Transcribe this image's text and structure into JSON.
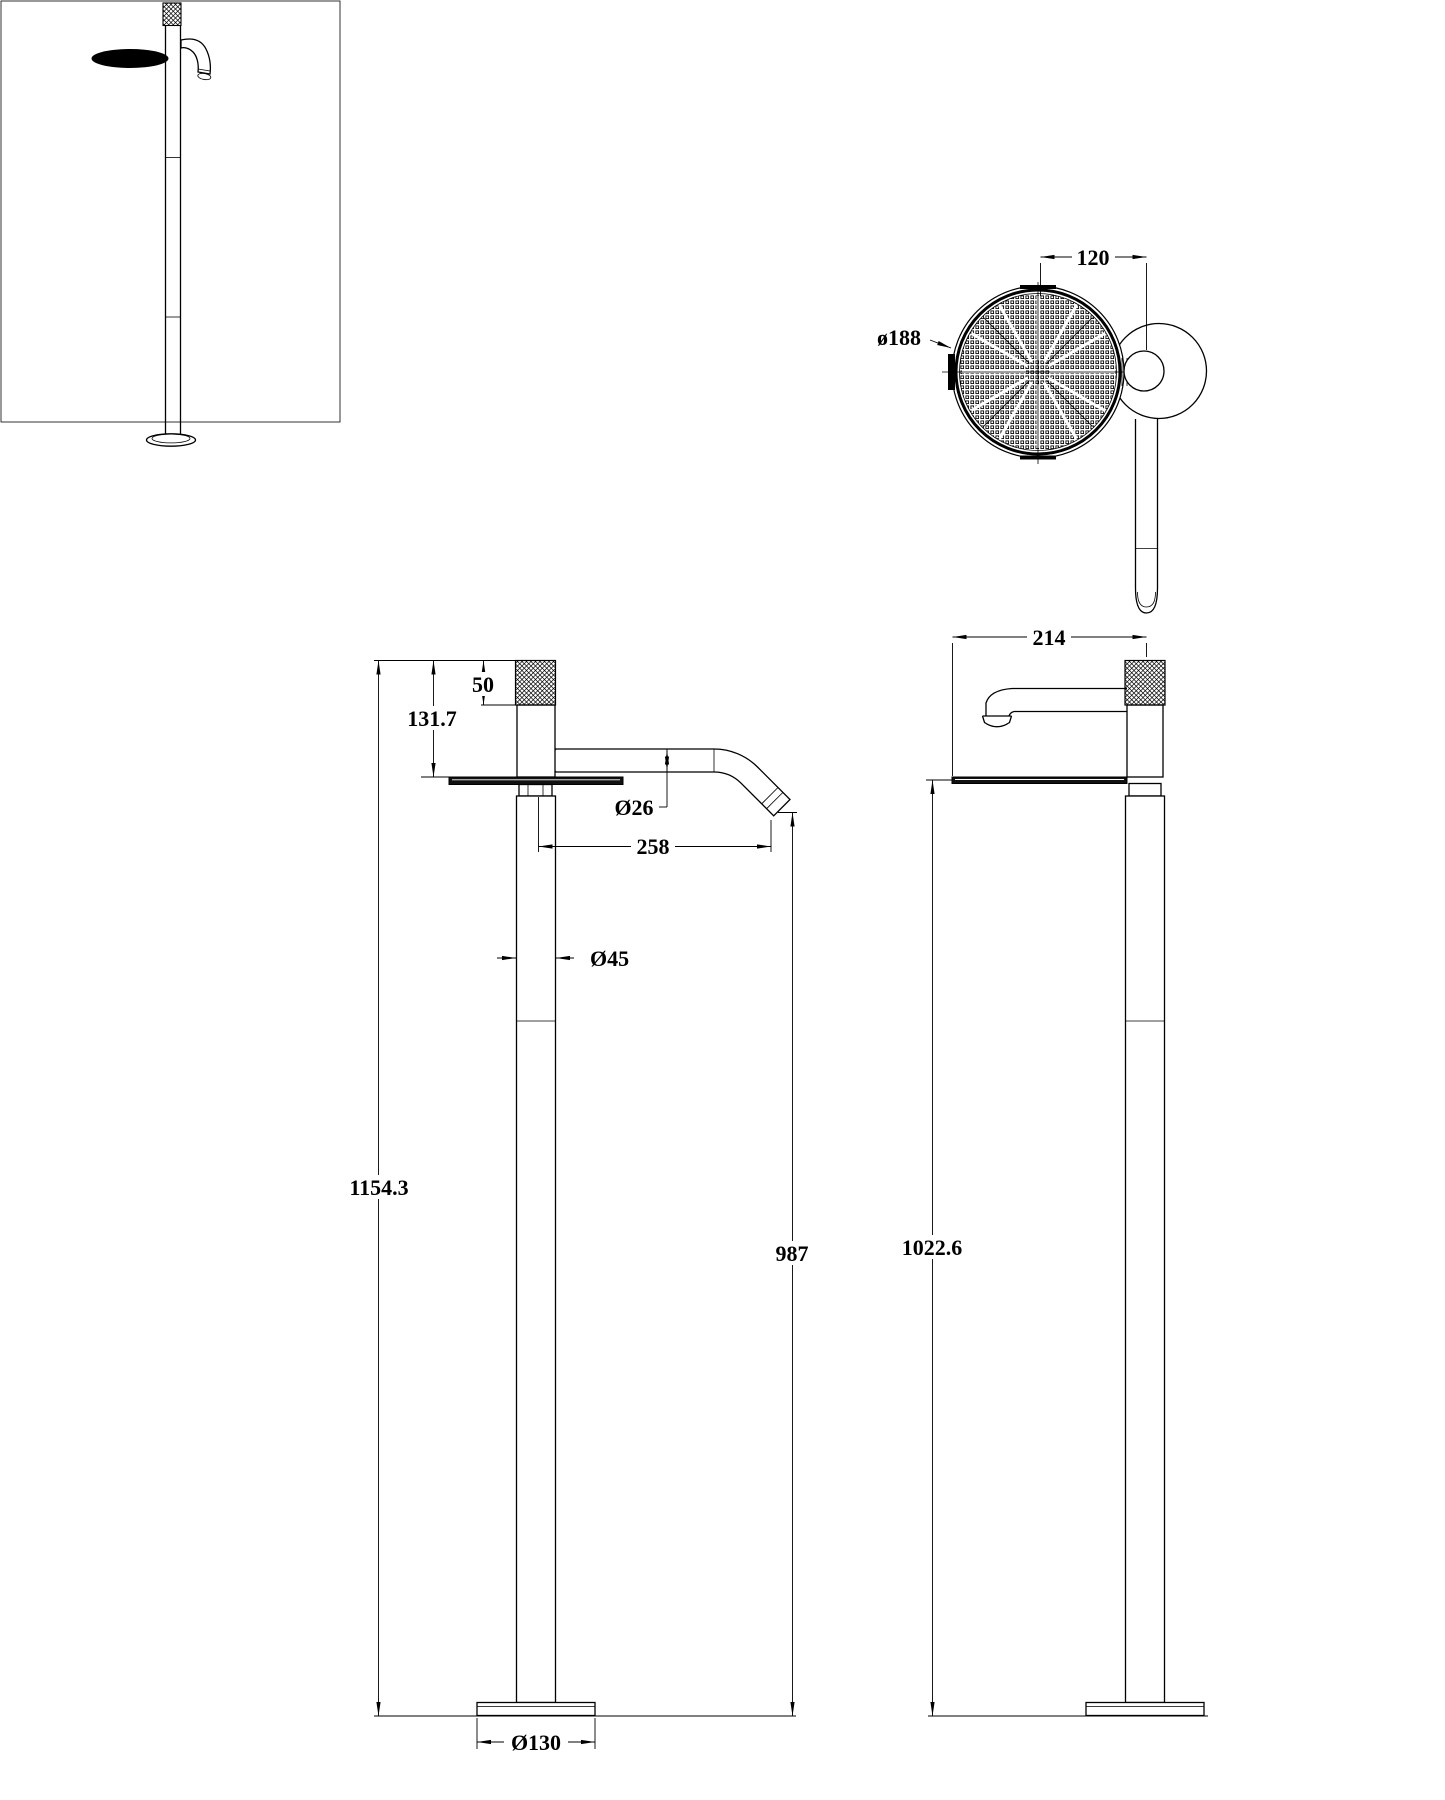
{
  "colors": {
    "line": "#000000",
    "background": "#ffffff"
  },
  "views": {
    "isometric": {
      "label": ""
    },
    "top": {
      "width": "120",
      "diameter": "ø188"
    },
    "front": {
      "cap_height": "50",
      "cap_to_shelf": "131.7",
      "spout_diameter": "Ø26",
      "spout_reach": "258",
      "pole_diameter": "Ø45",
      "total_height": "1154.3",
      "spout_height": "987",
      "base_diameter": "Ø130"
    },
    "side": {
      "depth": "214",
      "shelf_height": "1022.6"
    }
  }
}
